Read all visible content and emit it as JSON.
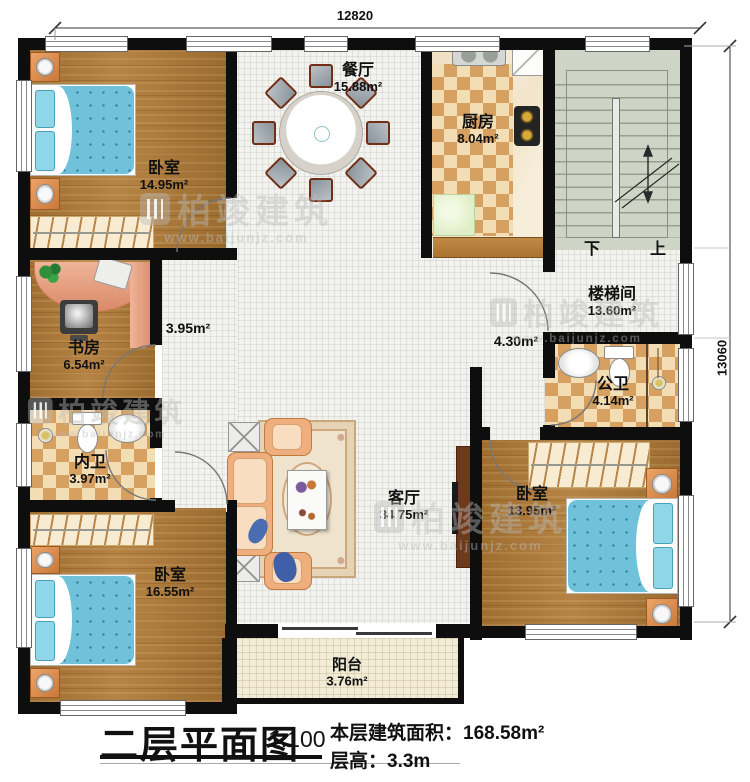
{
  "plan": {
    "title": "二层平面图",
    "scale": "1:100",
    "floor_area_label": "本层建筑面积：",
    "floor_area_value": "168.58m²",
    "floor_height_label": "层高：",
    "floor_height_value": "3.3m"
  },
  "dimensions": {
    "width": "12820",
    "height": "13060"
  },
  "rooms": {
    "bedroom_nw": {
      "name": "卧室",
      "area": "14.95m²"
    },
    "dining": {
      "name": "餐厅",
      "area": "15.88m²"
    },
    "kitchen": {
      "name": "厨房",
      "area": "8.04m²"
    },
    "stairwell": {
      "name": "楼梯间",
      "area": "13.60m²"
    },
    "study": {
      "name": "书房",
      "area": "6.54m²"
    },
    "hall_west": {
      "area": "3.95m²"
    },
    "hall_east": {
      "area": "4.30m²"
    },
    "bath_inner": {
      "name": "内卫",
      "area": "3.97m²"
    },
    "bath_public": {
      "name": "公卫",
      "area": "4.14m²"
    },
    "living": {
      "name": "客厅",
      "area": "34.75m²"
    },
    "bedroom_sw": {
      "name": "卧室",
      "area": "16.55m²"
    },
    "bedroom_se": {
      "name": "卧室",
      "area": "13.95m²"
    },
    "balcony": {
      "name": "阳台",
      "area": "3.76m²"
    }
  },
  "stairs": {
    "down_label": "下",
    "up_label": "上"
  },
  "watermark": {
    "brand": "柏竣建筑",
    "url": "www.baijunjz.com"
  }
}
